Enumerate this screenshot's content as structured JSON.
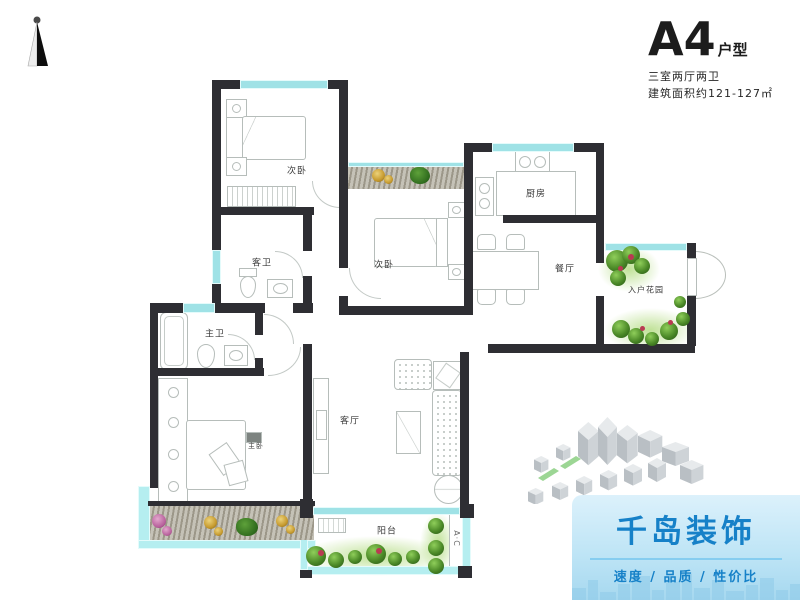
{
  "title_block": {
    "code": "A4",
    "code_suffix": "户型",
    "spec_line": "三室两厅两卫",
    "area_line": "建筑面积约121-127㎡"
  },
  "floor_plan": {
    "rooms": [
      {
        "key": "bedroom_top",
        "label": "次卧"
      },
      {
        "key": "guest_bath",
        "label": "客卫"
      },
      {
        "key": "bedroom_mid",
        "label": "次卧"
      },
      {
        "key": "kitchen",
        "label": "厨房"
      },
      {
        "key": "dining",
        "label": "餐厅"
      },
      {
        "key": "entry_garden",
        "label": "入户花园"
      },
      {
        "key": "master_bath",
        "label": "主卫"
      },
      {
        "key": "master_bedroom",
        "label": "主卧"
      },
      {
        "key": "living",
        "label": "客厅"
      },
      {
        "key": "balcony",
        "label": "阳台"
      }
    ],
    "balcony_marker": "A·C",
    "colors": {
      "wall": "#2e2e33",
      "window_teal": "#9fe2e6",
      "furniture_line": "#b6bdba",
      "plant_green": "#4c8a28",
      "flower_red": "#b93a52",
      "planter_gray": "#b2ad9f"
    }
  },
  "branding": {
    "name": "千岛装饰",
    "tagline": "速度 / 品质 / 性价比",
    "text_color": "#1681c8"
  }
}
